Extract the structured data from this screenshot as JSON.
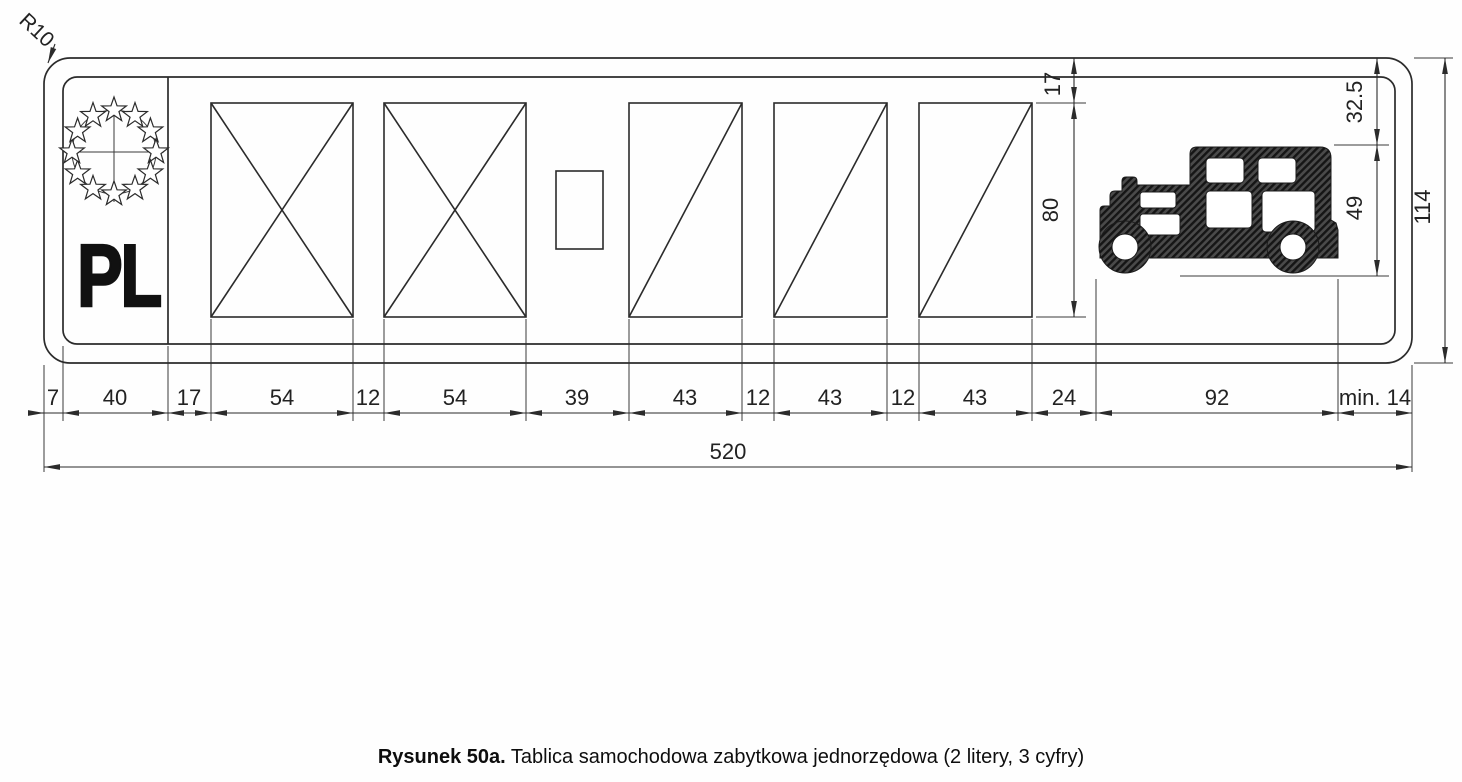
{
  "figure": {
    "caption_label": "Rysunek 50a.",
    "caption_text": "Tablica samochodowa zabytkowa jednorzędowa (2 litery, 3 cyfry)"
  },
  "plate": {
    "country_code": "PL",
    "corner_radius": "R10"
  },
  "dimensions": {
    "bottom": [
      "7",
      "40",
      "17",
      "54",
      "12",
      "54",
      "39",
      "43",
      "12",
      "43",
      "12",
      "43",
      "24",
      "92",
      "min. 14"
    ],
    "total_width": "520",
    "top_margin": "17",
    "char_field_height": "80",
    "emblem_top_offset": "32.5",
    "emblem_height": "49",
    "total_height": "114"
  },
  "icons": {
    "eu_stars": "eu-stars-emblem",
    "vintage_car": "vintage-car-icon"
  },
  "colors": {
    "line": "#2b2b2b",
    "background": "#ffffff"
  }
}
